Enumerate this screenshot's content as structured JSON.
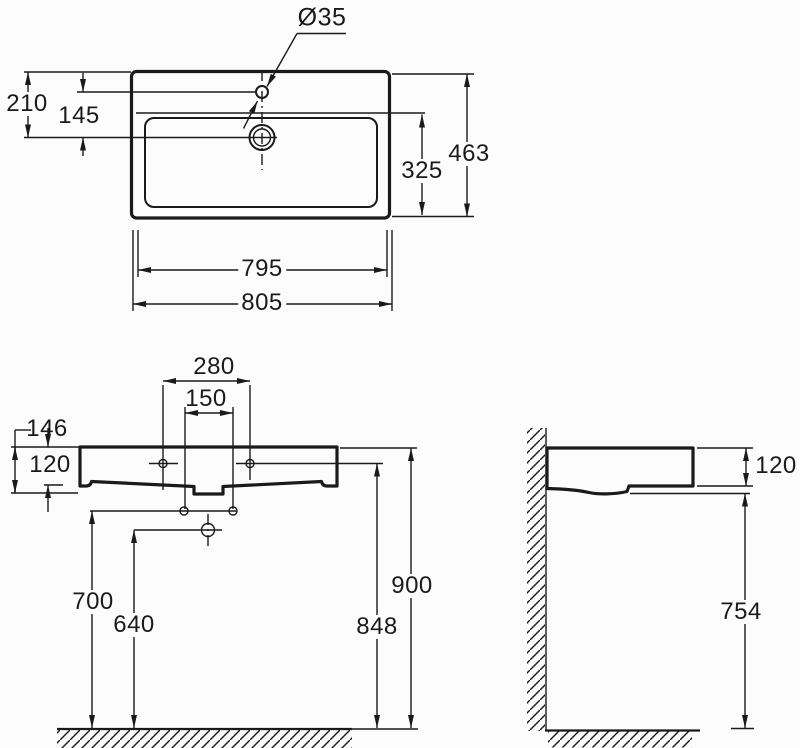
{
  "drawing": {
    "background_color": "#fcfcfc",
    "line_color": "#1a1a1a"
  },
  "labels": {
    "dia": "Ø35",
    "top_210": "210",
    "top_145": "145",
    "top_463": "463",
    "top_325": "325",
    "top_795": "795",
    "top_805": "805",
    "front_280": "280",
    "front_150": "150",
    "front_146": "146",
    "front_120": "120",
    "front_700": "700",
    "front_640": "640",
    "front_848": "848",
    "front_900": "900",
    "side_120": "120",
    "side_754": "754"
  }
}
